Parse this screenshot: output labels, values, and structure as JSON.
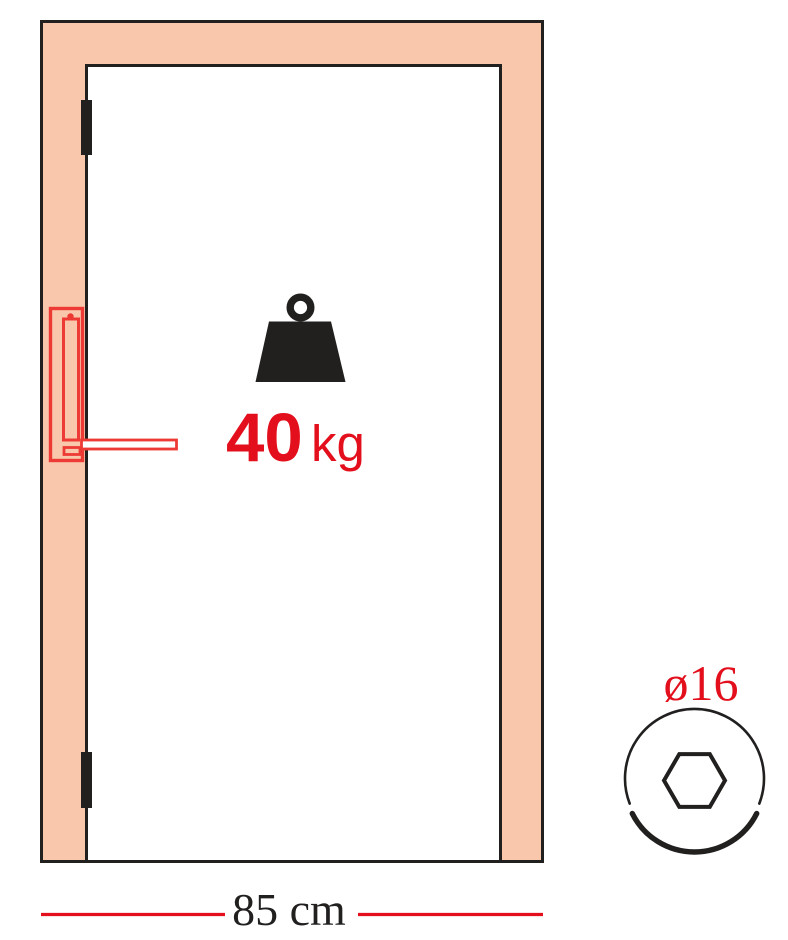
{
  "meta": {
    "title": "Door assembly specification diagram",
    "description": "Front view of a door in its frame with hinges and lock handle, maximum door weight, door width dimension and hex-socket screw head diameter"
  },
  "colors": {
    "background": "#ffffff",
    "frame-fill": "#f9c8ac",
    "line-black": "#221f1f",
    "accent-red": "#e30f1c",
    "handle-red": "#ee3a34"
  },
  "labels": {
    "weight_value": "40",
    "weight_unit": "kg",
    "door_width": "85 cm",
    "screw_diameter": "ø16"
  },
  "icons": {
    "weight": "weight-icon (kettlebell trapezoid with ring)",
    "hinge_top": "hinge-icon",
    "hinge_bottom": "hinge-icon",
    "handle": "lock-handle-icon",
    "screw_head": "hex-socket-screw-head-icon"
  }
}
